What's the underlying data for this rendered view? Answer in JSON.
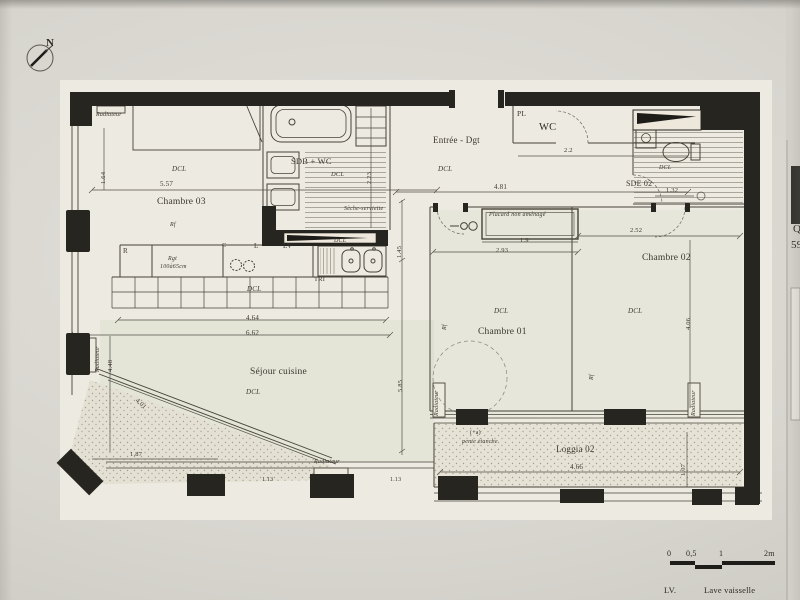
{
  "photo": {
    "north_label": "N",
    "edge_fragments": {
      "line1": "Q",
      "line2": "59"
    }
  },
  "rooms": {
    "chambre03": {
      "name": "Chambre 03"
    },
    "sdb": {
      "name": "SDB + WC"
    },
    "entree": {
      "name": "Entrée - Dgt"
    },
    "wc": {
      "name": "WC"
    },
    "pl": {
      "name": "PL"
    },
    "sde02": {
      "name": "SDE 02"
    },
    "chambre01": {
      "name": "Chambre 01"
    },
    "chambre02": {
      "name": "Chambre 02"
    },
    "sejour": {
      "name": "Séjour cuisine"
    },
    "loggia02": {
      "name": "Loggia 02"
    }
  },
  "annotations": {
    "dcl": "DCL",
    "radiateur": "Radiateur",
    "seche_serviette": "Sèche-serviette",
    "placard": "Placard non aménagé",
    "rf": "Rf",
    "tri": "TRI",
    "r": "R",
    "c": "C",
    "l": "L",
    "lv": "LV",
    "rgt_line1": "Rgt",
    "rgt_line2": "100à65cm",
    "pente_mark": "(+a)",
    "pente": "pente étanche"
  },
  "dimensions": {
    "chambre03_w": "5.57",
    "chambre03_h": "1.64",
    "sdb_h": "2.23",
    "entree_w": "4.81",
    "entree_h": "1.45",
    "wc_w": "2.2",
    "sde02_w": "1.32",
    "placard_w": "1.9",
    "chambre01_w": "2.93",
    "chambre02_w": "2.52",
    "chambre02_h": "4.06",
    "kitchen_w": "4.64",
    "sejour_w": "6.62",
    "sejour_h": "5.85",
    "sejour_left_h": "4.48",
    "bay_diag": "4.01",
    "bay_w": "1.87",
    "loggia_w": "4.66",
    "loggia_h": "1.07",
    "window_w": "1.13"
  },
  "scalebar": {
    "t0": "0",
    "t05": "0,5",
    "t1": "1",
    "t2": "2m"
  },
  "legend": {
    "abbr": "LV.",
    "meaning": "Lave vaisselle"
  }
}
